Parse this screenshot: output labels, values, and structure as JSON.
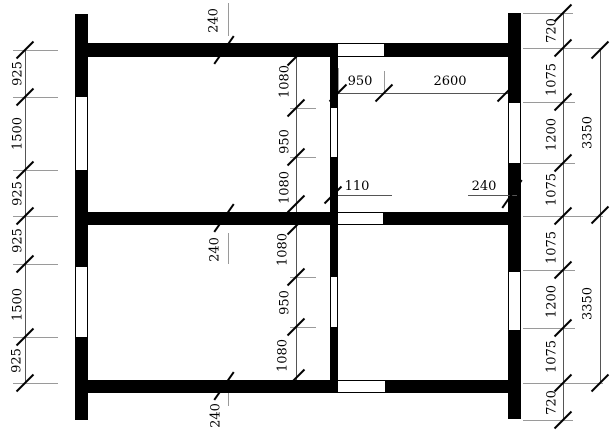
{
  "drawing": {
    "left_chain": [
      "925",
      "1500",
      "925",
      "925",
      "1500",
      "925"
    ],
    "upper_inner_chain": [
      "1080",
      "950",
      "1080"
    ],
    "lower_inner_chain": [
      "1080",
      "950",
      "1080"
    ],
    "right_chain": [
      "720",
      "1075",
      "1200",
      "1075",
      "1075",
      "1200",
      "1075",
      "720"
    ],
    "right_totals": [
      "3350",
      "3350"
    ],
    "wall_thickness": {
      "top": "240",
      "middle": "240",
      "bottom": "240"
    },
    "partition_thickness": "110",
    "right_wall_thickness": "240",
    "top_room": {
      "opening": "950",
      "span": "2600"
    }
  },
  "colors": {
    "wall": "#000000",
    "dimension_line": "#555555",
    "extension_line": "#9a9a9a",
    "text": "#000000",
    "background": "#ffffff"
  }
}
